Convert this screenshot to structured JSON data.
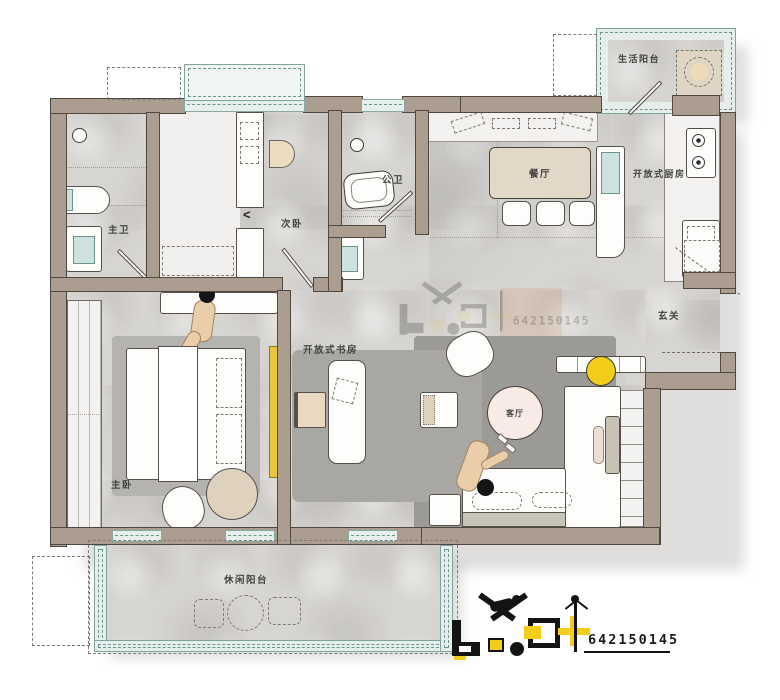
{
  "rooms": {
    "master_bath": "主卫",
    "secondary_bedroom": "次卧",
    "public_bath": "公卫",
    "dining": "餐厅",
    "open_kitchen": "开放式厨房",
    "service_balcony": "生活阳台",
    "entry": "玄关",
    "open_study": "开放式书房",
    "living": "客厅",
    "master_bedroom": "主卧",
    "leisure_balcony": "休闲阳台"
  },
  "watermark": {
    "id_number": "642150145"
  },
  "glyphs": {
    "closet_arrow": "<"
  },
  "colors": {
    "wall": "#ab9e90",
    "wall_outline": "#4e4840",
    "floor": "#d7d5d2",
    "rug_living": "#9c9a97",
    "window_teal": "#85a9a3",
    "accent_yellow": "#f2ce1b",
    "coffee_table_pink": "#f8ebe5",
    "wood_beige": "#e6dac6"
  }
}
